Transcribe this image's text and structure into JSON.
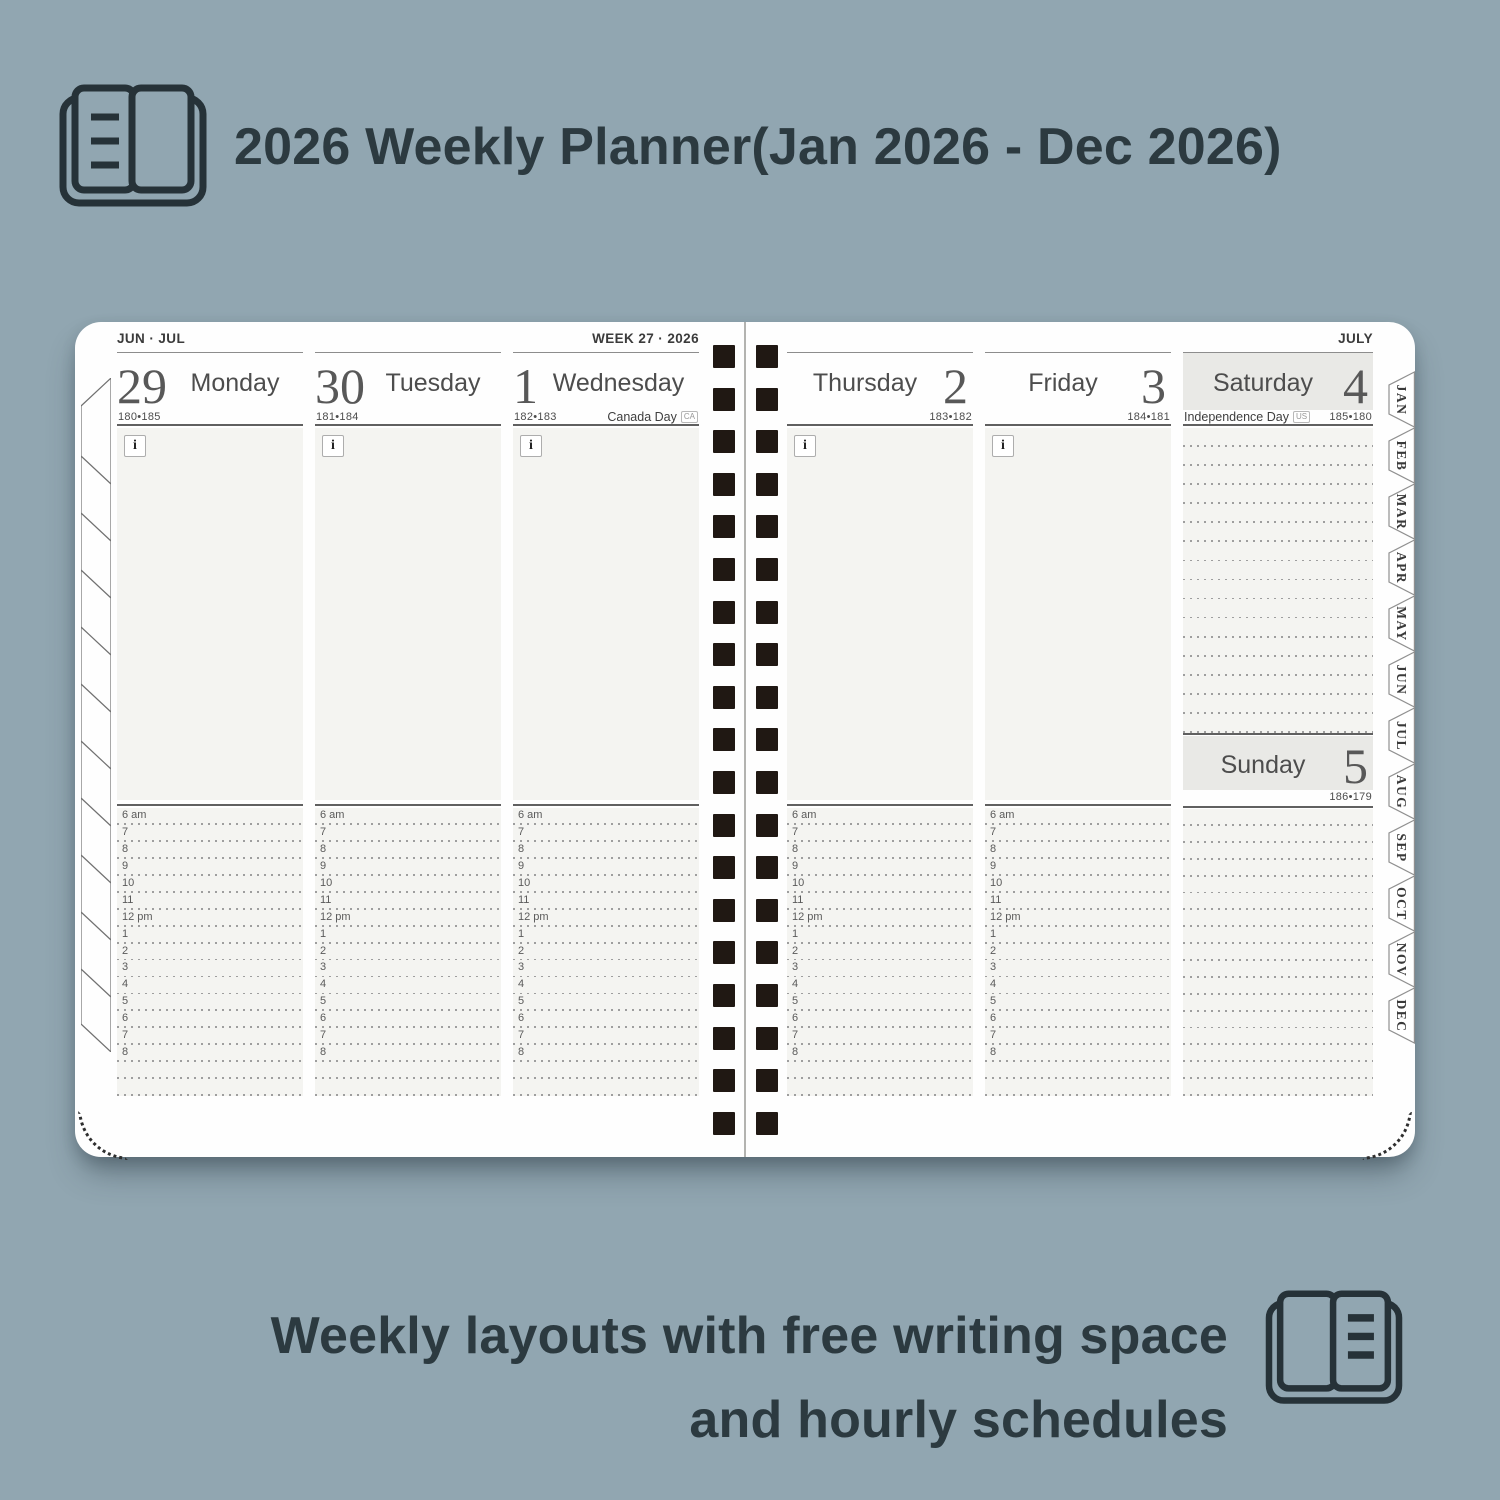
{
  "header": {
    "title": "2026 Weekly Planner(Jan 2026 - Dec 2026)",
    "icon": "open-book-icon"
  },
  "footer": {
    "line1": "Weekly layouts with free writing space",
    "line2": "and hourly schedules",
    "icon": "open-book-icon"
  },
  "planner": {
    "left_page": {
      "corner_label": "JUN · JUL",
      "week_label": "WEEK 27 · 2026"
    },
    "right_page": {
      "corner_label": "JULY"
    },
    "weekdays": [
      {
        "number": "29",
        "name": "Monday",
        "day_count": "180•185",
        "holiday": "",
        "holiday_badge": ""
      },
      {
        "number": "30",
        "name": "Tuesday",
        "day_count": "181•184",
        "holiday": "",
        "holiday_badge": ""
      },
      {
        "number": "1",
        "name": "Wednesday",
        "day_count": "182•183",
        "holiday": "Canada Day",
        "holiday_badge": "CA"
      },
      {
        "number": "2",
        "name": "Thursday",
        "day_count": "183•182",
        "holiday": "",
        "holiday_badge": ""
      },
      {
        "number": "3",
        "name": "Friday",
        "day_count": "184•181",
        "holiday": "",
        "holiday_badge": ""
      }
    ],
    "weekend": {
      "saturday": {
        "number": "4",
        "name": "Saturday",
        "day_count": "185•180",
        "holiday": "Independence Day",
        "holiday_badge": "US"
      },
      "sunday": {
        "number": "5",
        "name": "Sunday",
        "day_count": "186•179"
      }
    },
    "hour_labels": [
      "6 am",
      "7",
      "8",
      "9",
      "10",
      "11",
      "12 pm",
      "1",
      "2",
      "3",
      "4",
      "5",
      "6",
      "7",
      "8"
    ],
    "unlabeled_hour_rows": 2,
    "saturday_free_rows": 16,
    "saturday_lower_rows": 17,
    "month_tabs": [
      "JAN",
      "FEB",
      "MAR",
      "APR",
      "MAY",
      "JUN",
      "JUL",
      "AUG",
      "SEP",
      "OCT",
      "NOV",
      "DEC"
    ],
    "info_icon_label": "i"
  },
  "colors": {
    "background": "#91a6b1",
    "ink": "#2c3a40",
    "panel_gray": "#f4f4f1",
    "weekend_gray": "#e9e9e6",
    "binding": "#201813"
  }
}
